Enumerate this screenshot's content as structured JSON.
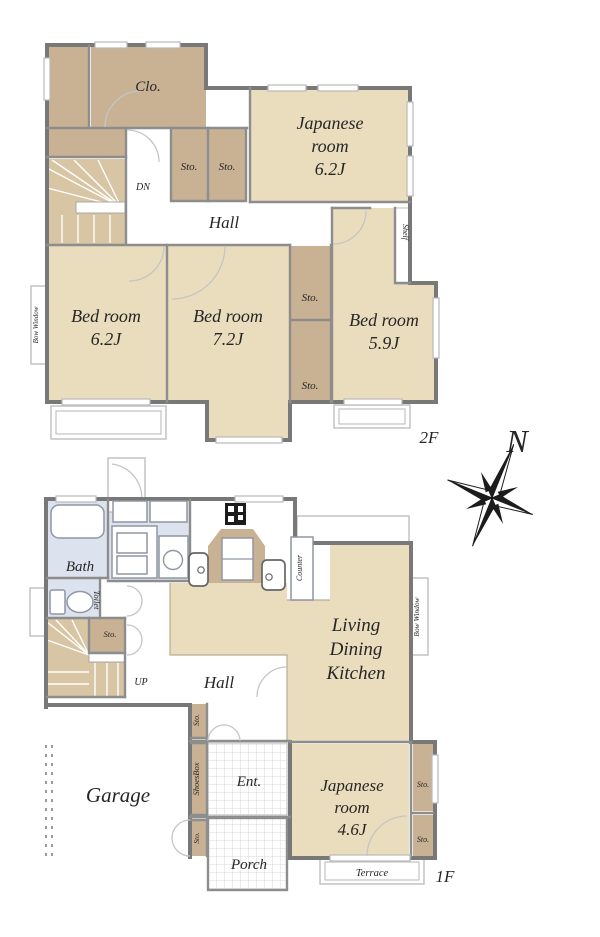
{
  "plan": {
    "floor2": {
      "floor_label": "2F",
      "closet": "Clo.",
      "japanese": [
        "Japanese",
        "room",
        "6.2J"
      ],
      "sto_a": "Sto.",
      "sto_b": "Sto.",
      "dn": "DN",
      "hall": "Hall",
      "shelf": "Shelf",
      "bow_window": "Bow Window",
      "bed1": [
        "Bed room",
        "6.2J"
      ],
      "bed2": [
        "Bed room",
        "7.2J"
      ],
      "bed3": [
        "Bed room",
        "5.9J"
      ],
      "sto_c": "Sto.",
      "sto_d": "Sto."
    },
    "floor1": {
      "floor_label": "1F",
      "bath": "Bath",
      "toilet": "Toilet",
      "sto_stairs": "Sto.",
      "up": "UP",
      "hall": "Hall",
      "counter": "Counter",
      "bow_window": "Bow Window",
      "ldk": [
        "Living",
        "Dining",
        "Kitchen"
      ],
      "japanese": [
        "Japanese",
        "room",
        "4.6J"
      ],
      "sto_r1": "Sto.",
      "sto_r2": "Sto.",
      "garage": "Garage",
      "sto_sb1": "Sto.",
      "shoes_box": "ShoesBox",
      "sto_sb2": "Sto.",
      "ent": "Ent.",
      "porch": "Porch",
      "terrace": "Terrace"
    },
    "compass": {
      "north": "N"
    }
  },
  "colors": {
    "room": "#EADDBD",
    "closet": "#C9B294",
    "stairsc": "#D7C5A3",
    "wet": "#DDE3EE",
    "wall": "#787878",
    "wallM": "#8D8D8D",
    "text": "#262626"
  }
}
